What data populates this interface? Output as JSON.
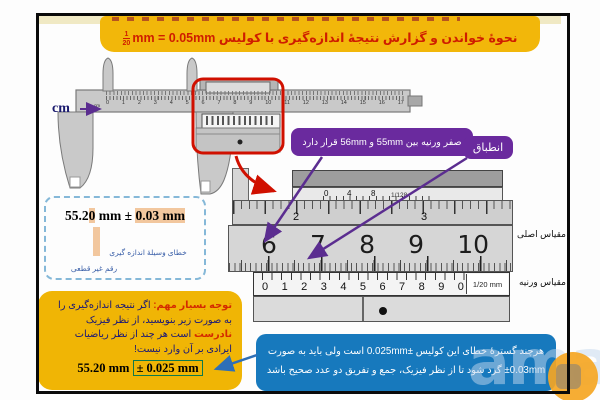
{
  "title": {
    "text": "نحوهٔ خواندن و گزارش نتیجهٔ اندازه‌گیری با کولیس",
    "frac_num": "1",
    "frac_den": "20",
    "formula": "mm = 0.05mm"
  },
  "caliper": {
    "cm_label": "cm",
    "beam_numbers": [
      "0",
      "1",
      "2",
      "3",
      "4",
      "5",
      "6",
      "7",
      "8",
      "9",
      "10",
      "11",
      "12",
      "13",
      "14",
      "15",
      "16",
      "17"
    ]
  },
  "callouts": {
    "vernier_zero": "صفر ورنیه بین 55mm و 56mm قرار دارد",
    "alignment": "انطباق"
  },
  "zoom_view": {
    "inch_vernier": {
      "labels": [
        "0",
        "4",
        "8"
      ],
      "unit": "1/128",
      "beam_labels": [
        "2",
        "3"
      ]
    },
    "main_scale": {
      "label": "مقیاس اصلی",
      "numbers": [
        "6",
        "7",
        "8",
        "9",
        "10"
      ]
    },
    "vernier_scale": {
      "label": "مقیاس ورنیه",
      "numbers": [
        "0",
        "1",
        "2",
        "3",
        "4",
        "5",
        "6",
        "7",
        "8",
        "9",
        "0"
      ],
      "unit": "1/20 mm"
    }
  },
  "measurement": {
    "value_prefix": "55.2",
    "uncertain_digit": "0",
    "separator": " mm ± ",
    "error": "0.03 mm",
    "error_label": "خطای وسیلهٔ اندازه گیری",
    "digit_label": "رقم غیر قطعی"
  },
  "note": {
    "title": "توجه بسیار مهم:",
    "body_1": "اگر نتیجه اندازه‌گیری را به صورت زیر بنویسید، از نظر فیزیک",
    "incorrect_word": "نادرست",
    "body_2": "است هر چند از نظر ریاضیات ایرادی بر آن وارد نیست!",
    "result_value": "55.20 mm ",
    "result_error": "± 0.025 mm"
  },
  "explanation": {
    "line1": "هرچند گسترهٔ خطای این کولیس ±0.025mm است ولی باید به صورت",
    "line2": "±0.03mm گرد شود تا از نظر فیزیک، جمع و تفریق دو عدد صحیح باشد"
  },
  "watermark": {
    "text": "ama"
  },
  "colors": {
    "title_gold": "#f2b70a",
    "title_red": "#cf1d00",
    "callout_purple": "#6a2a9e",
    "explanation_blue": "#1779bd",
    "note_navy": "#14147a",
    "highlight_orange": "#f2c79e",
    "result_green": "#0f7a4d",
    "annotation_red": "#d01000"
  }
}
